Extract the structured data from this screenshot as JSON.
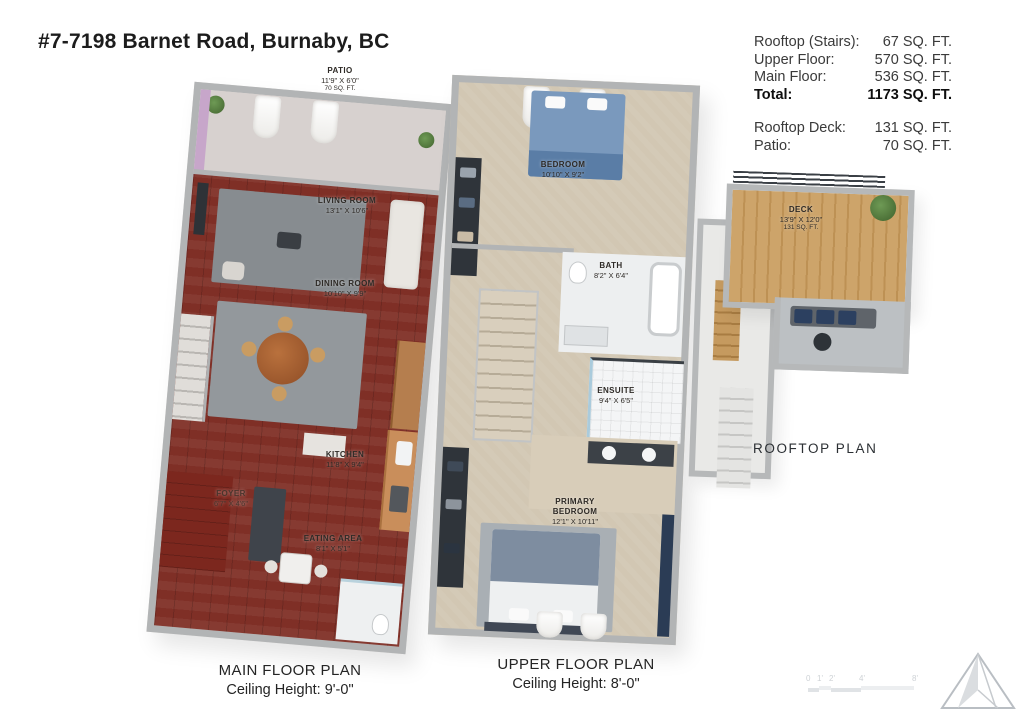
{
  "title": "#7-7198 Barnet Road, Burnaby, BC",
  "area_summary": {
    "group1": [
      {
        "label": "Rooftop (Stairs):",
        "value": "67 SQ. FT."
      },
      {
        "label": "Upper Floor:",
        "value": "570 SQ. FT."
      },
      {
        "label": "Main Floor:",
        "value": "536 SQ. FT."
      },
      {
        "label": "Total:",
        "value": "1173 SQ. FT."
      }
    ],
    "group2": [
      {
        "label": "Rooftop Deck:",
        "value": "131 SQ. FT."
      },
      {
        "label": "Patio:",
        "value": "70 SQ. FT."
      }
    ]
  },
  "main_floor": {
    "caption": "MAIN FLOOR PLAN",
    "ceiling": "Ceiling Height: 9'-0\"",
    "rooms": {
      "patio": {
        "name": "PATIO",
        "dims": "11'9\" X 6'0\"",
        "area": "70 SQ. FT."
      },
      "living": {
        "name": "LIVING ROOM",
        "dims": "13'1\" X 10'6\""
      },
      "dining": {
        "name": "DINING ROOM",
        "dims": "10'10\" X 9'9\""
      },
      "kitchen": {
        "name": "KITCHEN",
        "dims": "11'8\" X 9'4\""
      },
      "foyer": {
        "name": "FOYER",
        "dims": "6'7\" X 4'6\""
      },
      "eating": {
        "name": "EATING AREA",
        "dims": "8'1\" X 5'1\""
      }
    }
  },
  "upper_floor": {
    "caption": "UPPER FLOOR PLAN",
    "ceiling": "Ceiling Height: 8'-0\"",
    "rooms": {
      "bedroom": {
        "name": "BEDROOM",
        "dims": "10'10\" X 9'2\""
      },
      "bath": {
        "name": "BATH",
        "dims": "8'2\" X 6'4\""
      },
      "ensuite": {
        "name": "ENSUITE",
        "dims": "9'4\" X 6'5\""
      },
      "primary": {
        "name": "PRIMARY BEDROOM",
        "dims": "12'1\" X 10'11\""
      }
    }
  },
  "rooftop": {
    "caption": "ROOFTOP PLAN",
    "rooms": {
      "deck": {
        "name": "DECK",
        "dims": "13'9\" X 12'0\"",
        "area": "131 SQ. FT."
      }
    }
  },
  "scale_bar": {
    "ticks": [
      "0",
      "1'",
      "2'",
      "4'",
      "8'"
    ]
  },
  "icons": {
    "compass": "north-arrow-icon",
    "plant": "potted-plant-icon",
    "curtain": "curtain-icon"
  },
  "palette": {
    "hardwood": "#7f2f26",
    "carpet": "#d2c7b3",
    "deck_wood": "#cda46a",
    "wall_gray": "#b2b4b5",
    "accent_navy": "#2b3c55",
    "patio_wall_purple": "#c7a6ca",
    "bed_blue": "#7a99bd",
    "text": "#1c1c1c"
  }
}
